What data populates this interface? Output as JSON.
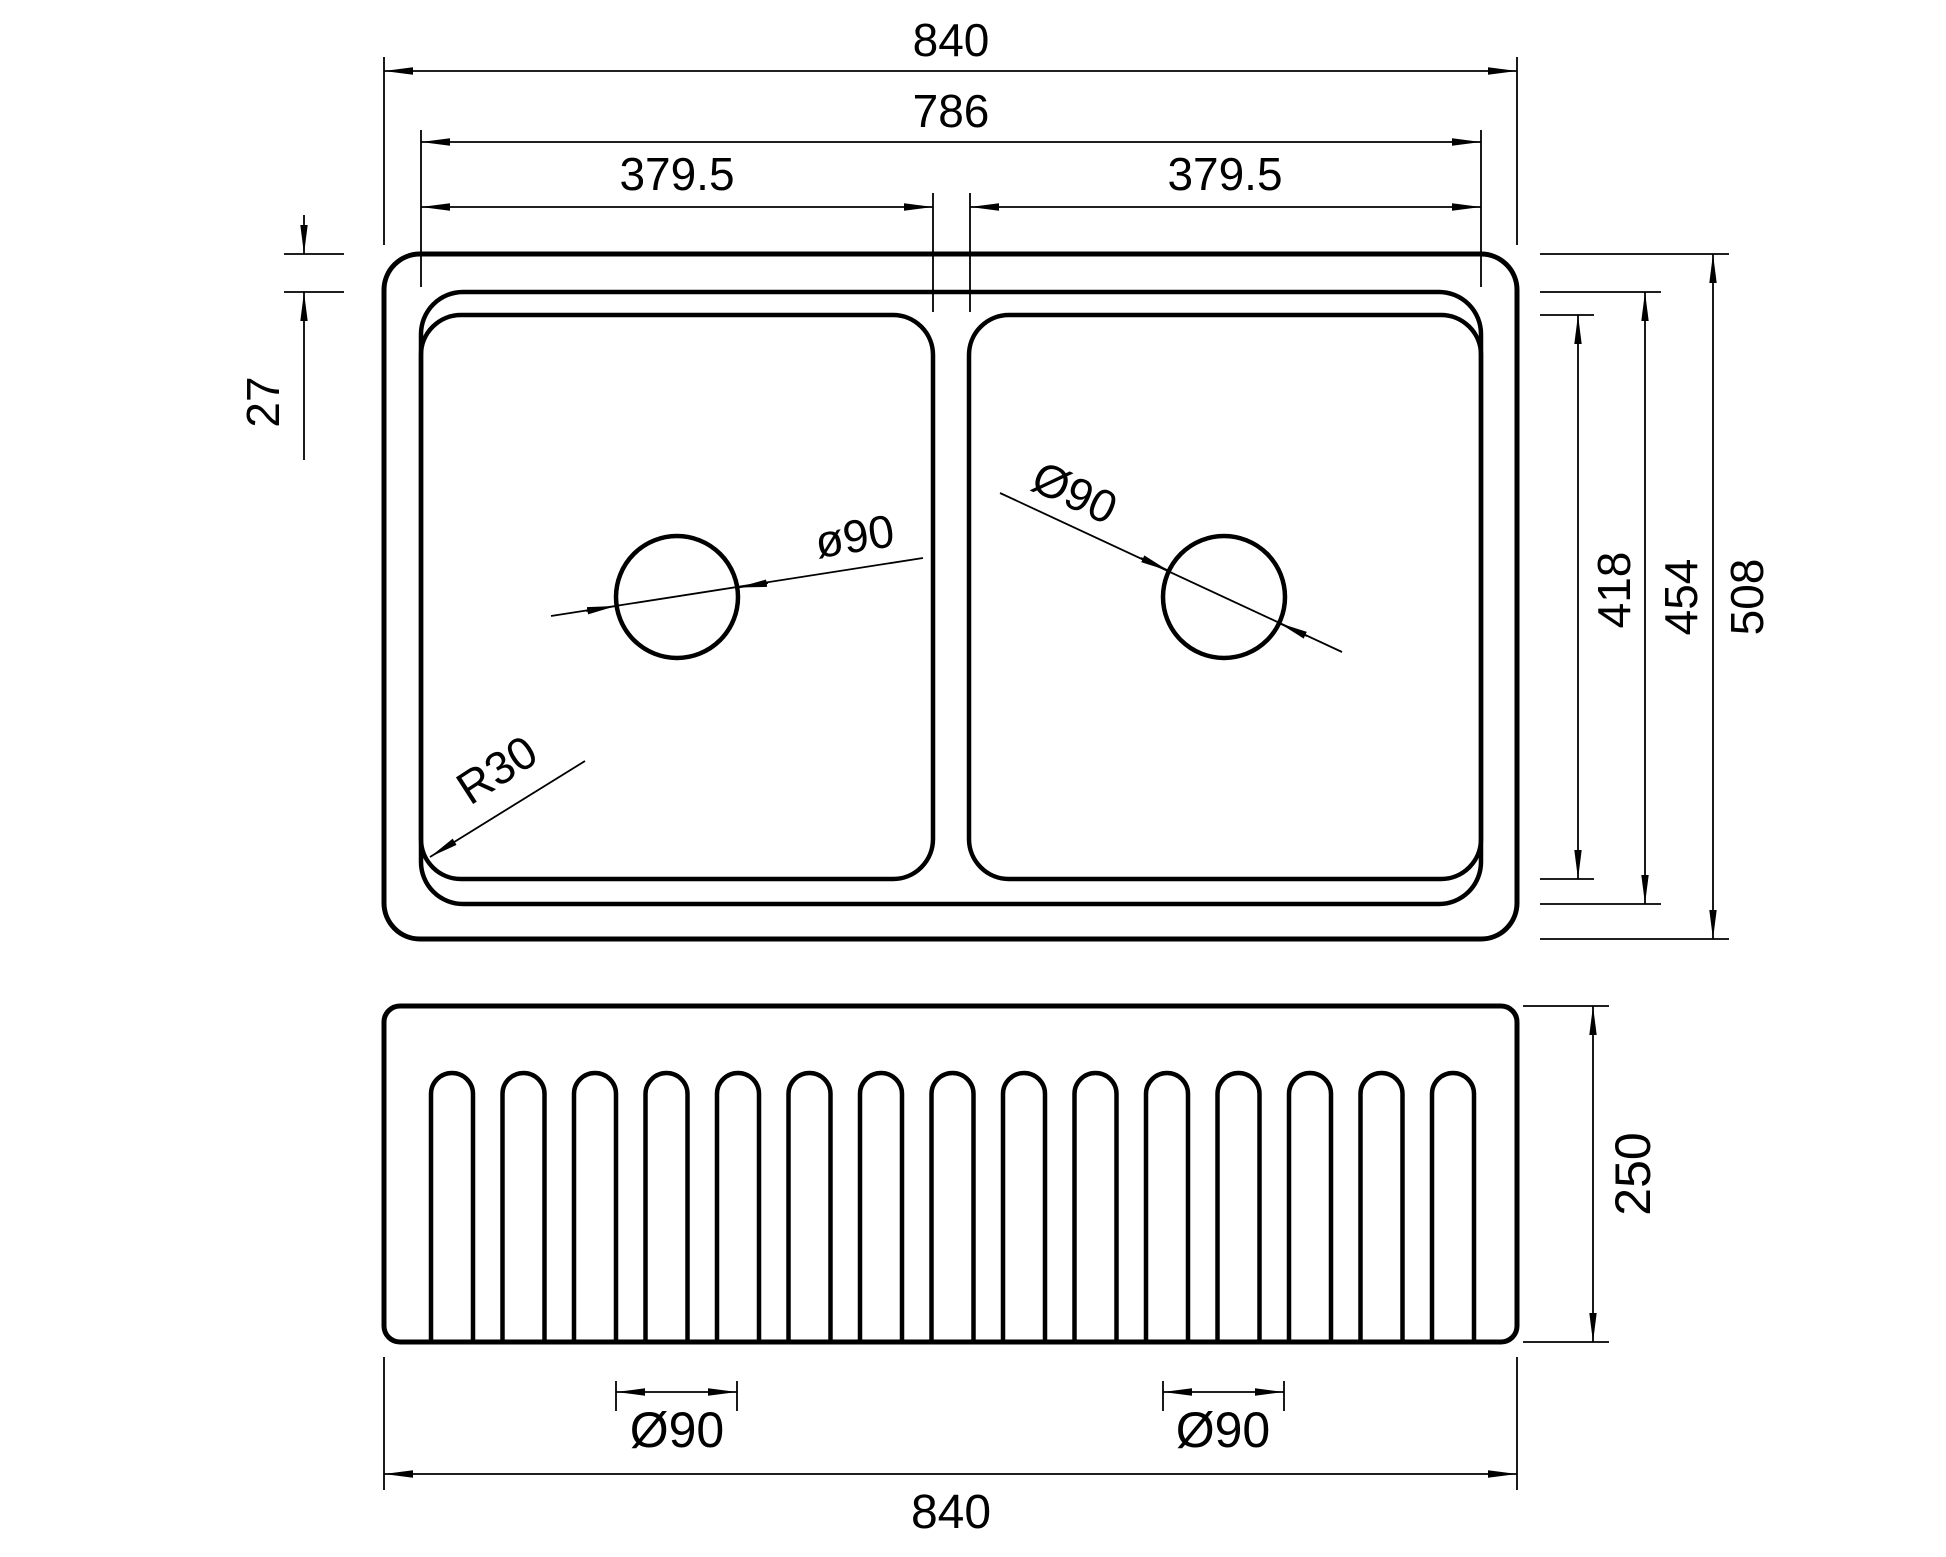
{
  "colors": {
    "line": "#000000",
    "background": "#ffffff"
  },
  "top_view": {
    "overall_width": "840",
    "inner_width": "786",
    "left_bowl_width": "379.5",
    "right_bowl_width": "379.5",
    "rim_width": "27",
    "bowl_length": "418",
    "inner_length": "454",
    "overall_length": "508",
    "left_drain_dia": "ø90",
    "right_drain_dia": "Ø90",
    "bowl_corner_radius": "R30"
  },
  "front_view": {
    "height": "250",
    "left_drain_dia": "Ø90",
    "right_drain_dia": "Ø90",
    "overall_width": "840",
    "flute_count": 15
  }
}
